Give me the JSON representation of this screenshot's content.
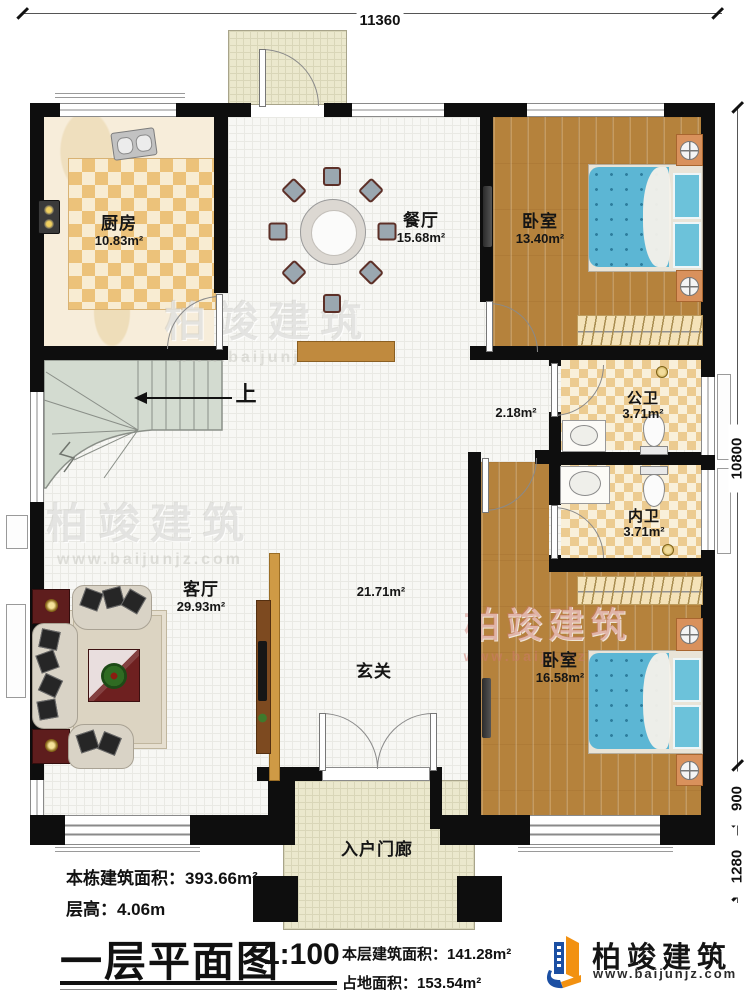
{
  "plan": {
    "dimensions": {
      "top": "11360",
      "right_upper": "10800",
      "right_middle": "900",
      "right_lower": "1280"
    },
    "rooms": {
      "kitchen": {
        "label": "厨房",
        "area": "10.83m²"
      },
      "dining": {
        "label": "餐厅",
        "area": "15.68m²"
      },
      "bedroom_top": {
        "label": "卧室",
        "area": "13.40m²"
      },
      "public_bath": {
        "label": "公卫",
        "area": "3.71m²"
      },
      "inner_bath": {
        "label": "内卫",
        "area": "3.71m²"
      },
      "bedroom_bottom": {
        "label": "卧室",
        "area": "16.58m²"
      },
      "living": {
        "label": "客厅",
        "area": "29.93m²"
      },
      "foyer": {
        "label": "玄关",
        "area": "21.71m²"
      },
      "hallway": {
        "area": "2.18m²"
      },
      "entry_porch": {
        "label": "入户门廊"
      }
    },
    "stairs": {
      "up_label": "上"
    }
  },
  "title_block": {
    "building_total_area": "本栋建筑面积：393.66m²",
    "floor_height": "层高：4.06m",
    "plan_title": "一层平面图",
    "scale": "1:100",
    "floor_area": "本层建筑面积：141.28m²",
    "land_area": "占地面积：153.54m²"
  },
  "brand": {
    "name": "柏竣建筑",
    "website": "www.baijunjz.com"
  },
  "colors": {
    "wall": "#0e0e0e",
    "wood_floor": "#b5823c",
    "kitchen_checker": "#ecc27a",
    "bath_checker": "#eccb90",
    "bed": "#5cb6d4",
    "stairs": "#d3dbd0",
    "logo_blue": "#1b4fa3",
    "logo_orange": "#f29111",
    "accent_red": "#5e1d1d"
  }
}
